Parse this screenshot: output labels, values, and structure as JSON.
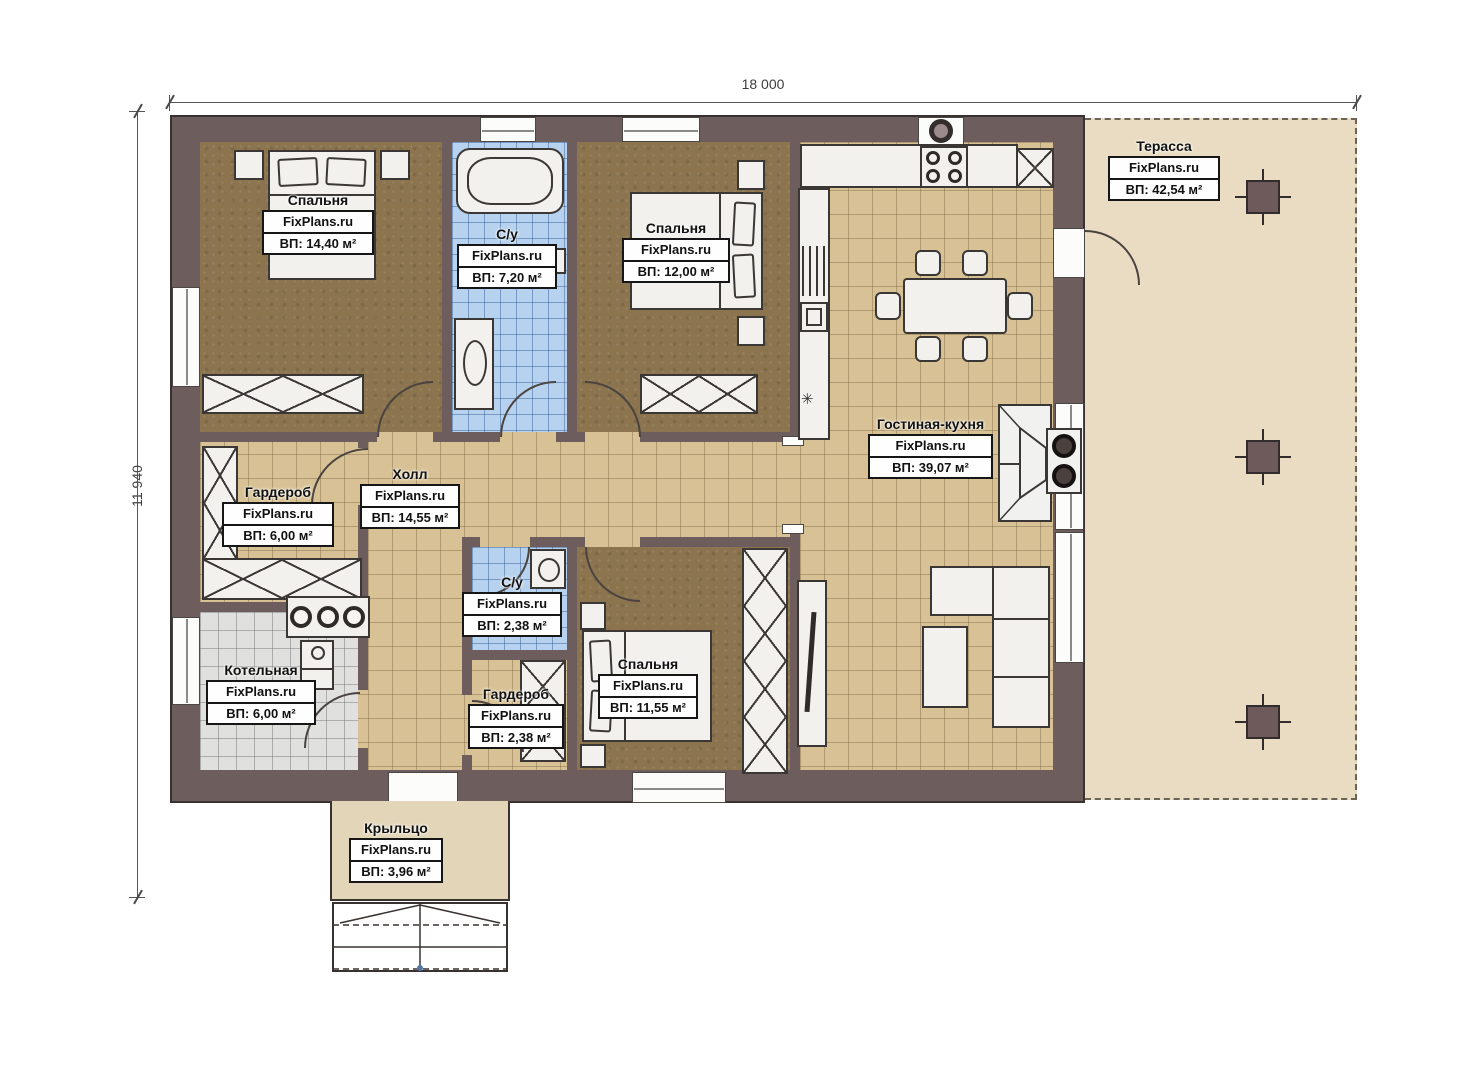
{
  "dimensions": {
    "width": "18 000",
    "height": "11 940"
  },
  "brand": "FixPlans.ru",
  "rooms": {
    "bedroom1": {
      "name": "Спальня",
      "area": "ВП: 14,40 м²"
    },
    "bathroom1": {
      "name": "С/у",
      "area": "ВП: 7,20 м²"
    },
    "bedroom2": {
      "name": "Спальня",
      "area": "ВП: 12,00 м²"
    },
    "terrace": {
      "name": "Терасса",
      "area": "ВП: 42,54 м²"
    },
    "living_kitchen": {
      "name": "Гостиная-кухня",
      "area": "ВП: 39,07 м²"
    },
    "wardrobe1": {
      "name": "Гардероб",
      "area": "ВП: 6,00 м²"
    },
    "hall": {
      "name": "Холл",
      "area": "ВП: 14,55 м²"
    },
    "bathroom2": {
      "name": "С/у",
      "area": "ВП: 2,38 м²"
    },
    "boiler": {
      "name": "Котельная",
      "area": "ВП: 6,00 м²"
    },
    "wardrobe2": {
      "name": "Гардероб",
      "area": "ВП: 2,38 м²"
    },
    "bedroom3": {
      "name": "Спальня",
      "area": "ВП: 11,55 м²"
    },
    "porch": {
      "name": "Крыльцо",
      "area": "ВП: 3,96 м²"
    }
  },
  "symbols": {
    "boiler_symbol": "✳"
  },
  "colors": {
    "wall": "#6e5d5d",
    "floor_wood": "#8b744e",
    "floor_tile": "#d8c295",
    "floor_bath": "#b7d2ee",
    "floor_boiler": "#e0e0df",
    "terrace": "#e9dcc2",
    "porch": "#e3d5b8"
  }
}
